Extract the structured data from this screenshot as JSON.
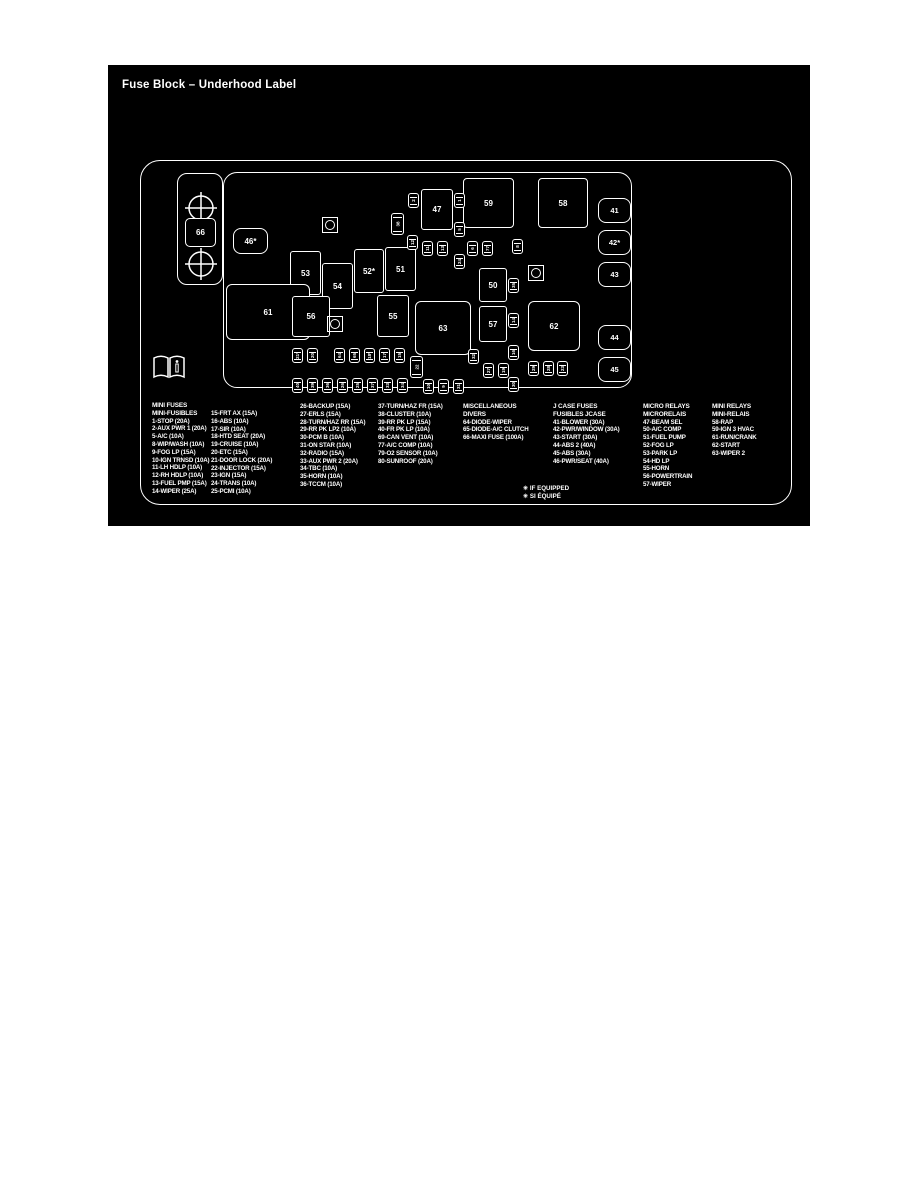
{
  "page": {
    "title": "Fuse Block – Underhood Label"
  },
  "footnotes": [
    "✳ IF EQUIPPED",
    "✳ SI ÉQUIPÉ"
  ],
  "diagram": {
    "maxi_fuse": {
      "label": "66",
      "x": 77,
      "y": 153,
      "w": 31,
      "h": 29
    },
    "boxes": [
      {
        "label": "46*",
        "x": 125,
        "y": 163,
        "w": 35,
        "h": 26,
        "r": 8
      },
      {
        "label": "53",
        "x": 182,
        "y": 186,
        "w": 31,
        "h": 44,
        "r": 3
      },
      {
        "label": "54",
        "x": 214,
        "y": 198,
        "w": 31,
        "h": 46,
        "r": 3
      },
      {
        "label": "52*",
        "x": 246,
        "y": 184,
        "w": 30,
        "h": 44,
        "r": 3
      },
      {
        "label": "51",
        "x": 277,
        "y": 182,
        "w": 31,
        "h": 44,
        "r": 3
      },
      {
        "label": "61",
        "x": 118,
        "y": 219,
        "w": 84,
        "h": 56,
        "r": 6
      },
      {
        "label": "56",
        "x": 184,
        "y": 231,
        "w": 38,
        "h": 41,
        "r": 3
      },
      {
        "label": "55",
        "x": 269,
        "y": 230,
        "w": 32,
        "h": 42,
        "r": 3
      },
      {
        "label": "63",
        "x": 307,
        "y": 236,
        "w": 56,
        "h": 54,
        "r": 6
      },
      {
        "label": "47",
        "x": 313,
        "y": 124,
        "w": 32,
        "h": 41,
        "r": 3
      },
      {
        "label": "59",
        "x": 355,
        "y": 113,
        "w": 51,
        "h": 50,
        "r": 4
      },
      {
        "label": "58",
        "x": 430,
        "y": 113,
        "w": 50,
        "h": 50,
        "r": 4
      },
      {
        "label": "50",
        "x": 371,
        "y": 203,
        "w": 28,
        "h": 34,
        "r": 3
      },
      {
        "label": "57",
        "x": 371,
        "y": 241,
        "w": 28,
        "h": 36,
        "r": 3
      },
      {
        "label": "62",
        "x": 420,
        "y": 236,
        "w": 52,
        "h": 50,
        "r": 6
      }
    ],
    "jcase_fuses": [
      {
        "label": "41",
        "x": 490,
        "y": 133
      },
      {
        "label": "42*",
        "x": 490,
        "y": 165
      },
      {
        "label": "43",
        "x": 490,
        "y": 197
      },
      {
        "label": "44",
        "x": 490,
        "y": 260
      },
      {
        "label": "45",
        "x": 490,
        "y": 292
      }
    ],
    "mini_fuses": [
      {
        "label": "2",
        "x": 300,
        "y": 128
      },
      {
        "label": "1",
        "x": 346,
        "y": 128
      },
      {
        "label": "38",
        "x": 283,
        "y": 148,
        "tall": true
      },
      {
        "label": "12",
        "x": 299,
        "y": 170
      },
      {
        "label": "11",
        "x": 314,
        "y": 176
      },
      {
        "label": "13",
        "x": 329,
        "y": 176
      },
      {
        "label": "5",
        "x": 346,
        "y": 157
      },
      {
        "label": "6",
        "x": 359,
        "y": 176
      },
      {
        "label": "77",
        "x": 374,
        "y": 176
      },
      {
        "label": "8",
        "x": 404,
        "y": 174
      },
      {
        "label": "24",
        "x": 346,
        "y": 189
      },
      {
        "label": "35",
        "x": 400,
        "y": 213
      },
      {
        "label": "14",
        "x": 400,
        "y": 248
      },
      {
        "label": "16",
        "x": 400,
        "y": 280
      },
      {
        "label": "30",
        "x": 400,
        "y": 312
      },
      {
        "label": "32",
        "x": 360,
        "y": 284
      },
      {
        "label": "27",
        "x": 375,
        "y": 298
      },
      {
        "label": "19",
        "x": 390,
        "y": 298
      },
      {
        "label": "29",
        "x": 420,
        "y": 296
      },
      {
        "label": "28",
        "x": 435,
        "y": 296
      },
      {
        "label": "23",
        "x": 449,
        "y": 296
      },
      {
        "label": "21*",
        "x": 184,
        "y": 283
      },
      {
        "label": "20",
        "x": 199,
        "y": 283
      },
      {
        "label": "64",
        "x": 226,
        "y": 283
      },
      {
        "label": "65",
        "x": 241,
        "y": 283
      },
      {
        "label": "18*",
        "x": 256,
        "y": 283
      },
      {
        "label": "17",
        "x": 271,
        "y": 283
      },
      {
        "label": "15",
        "x": 286,
        "y": 283
      },
      {
        "label": "22",
        "x": 302,
        "y": 291,
        "tall": true
      },
      {
        "label": "40",
        "x": 184,
        "y": 313
      },
      {
        "label": "39",
        "x": 199,
        "y": 313
      },
      {
        "label": "36",
        "x": 214,
        "y": 313
      },
      {
        "label": "26",
        "x": 229,
        "y": 313
      },
      {
        "label": "25",
        "x": 244,
        "y": 313
      },
      {
        "label": "37",
        "x": 259,
        "y": 313
      },
      {
        "label": "33",
        "x": 274,
        "y": 313
      },
      {
        "label": "34",
        "x": 289,
        "y": 313
      },
      {
        "label": "10",
        "x": 315,
        "y": 314
      },
      {
        "label": "9",
        "x": 330,
        "y": 314
      },
      {
        "label": "31",
        "x": 345,
        "y": 314
      }
    ],
    "test_points": [
      {
        "x": 214,
        "y": 152
      },
      {
        "x": 420,
        "y": 200
      },
      {
        "x": 219,
        "y": 251
      }
    ]
  },
  "legend": {
    "columns": [
      {
        "header": [
          "MINI FUSES",
          "MINI-FUSIBLES"
        ],
        "items": [
          "1-STOP (20A)",
          "2-AUX PWR 1 (20A)",
          "5-A/C (10A)",
          "8-WIP/WASH (10A)",
          "9-FOG LP (15A)",
          "10-IGN TRNSD (10A)",
          "11-LH HDLP (10A)",
          "12-RH HDLP (10A)",
          "13-FUEL PMP (15A)",
          "14-WIPER (25A)"
        ]
      },
      {
        "header": [],
        "items": [
          "15-FRT AX (15A)",
          "16-ABS (10A)",
          "17-SIR (10A)",
          "18-HTD SEAT (20A)",
          "19-CRUISE (10A)",
          "20-ETC (15A)",
          "21-DOOR LOCK (20A)",
          "22-INJECTOR (15A)",
          "23-IGN (15A)",
          "24-TRANS (10A)",
          "25-PCMI (10A)"
        ]
      },
      {
        "header": [],
        "items": [
          "26-BACKUP (15A)",
          "27-ERLS (15A)",
          "28-TURN/HAZ RR (15A)",
          "29-RR PK LP2 (10A)",
          "30-PCM B (10A)",
          "31-ON STAR (10A)",
          "32-RADIO (15A)",
          "33-AUX PWR 2 (20A)",
          "34-TBC (10A)",
          "35-HORN (10A)",
          "36-TCCM (10A)"
        ]
      },
      {
        "header": [],
        "items": [
          "37-TURN/HAZ FR (15A)",
          "38-CLUSTER (10A)",
          "39-RR PK LP (15A)",
          "40-FR PK LP (10A)",
          "69-CAN VENT (10A)",
          "77-A/C COMP (10A)",
          "79-O2 SENSOR (10A)",
          "80-SUNROOF (20A)"
        ]
      },
      {
        "header": [
          "MISCELLANEOUS",
          "DIVERS"
        ],
        "items": [
          "64-DIODE-WIPER",
          "65-DIODE-A/C CLUTCH",
          "66-MAXI FUSE (100A)"
        ]
      },
      {
        "header": [
          "J CASE FUSES",
          "FUSIBLES JCASE"
        ],
        "items": [
          "41-BLOWER (30A)",
          "42-PWR/WINDOW (30A)",
          "43-START (30A)",
          "44-ABS 2 (40A)",
          "45-ABS (30A)",
          "46-PWR/SEAT (40A)"
        ]
      },
      {
        "header": [
          "MICRO RELAYS",
          "MICRORELAIS"
        ],
        "items": [
          "47-BEAM SEL",
          "50-A/C COMP",
          "51-FUEL PUMP",
          "52-FOG LP",
          "53-PARK LP",
          "54-HD LP",
          "55-HORN",
          "56-POWERTRAIN",
          "57-WIPER"
        ]
      },
      {
        "header": [
          "MINI RELAYS",
          "MINI-RELAIS"
        ],
        "items": [
          "58-RAP",
          "59-IGN 3 HVAC",
          "61-RUN/CRANK",
          "62-START",
          "63-WIPER 2"
        ]
      }
    ]
  },
  "colors": {
    "background": "#000000",
    "foreground": "#ffffff",
    "page": "#ffffff"
  }
}
